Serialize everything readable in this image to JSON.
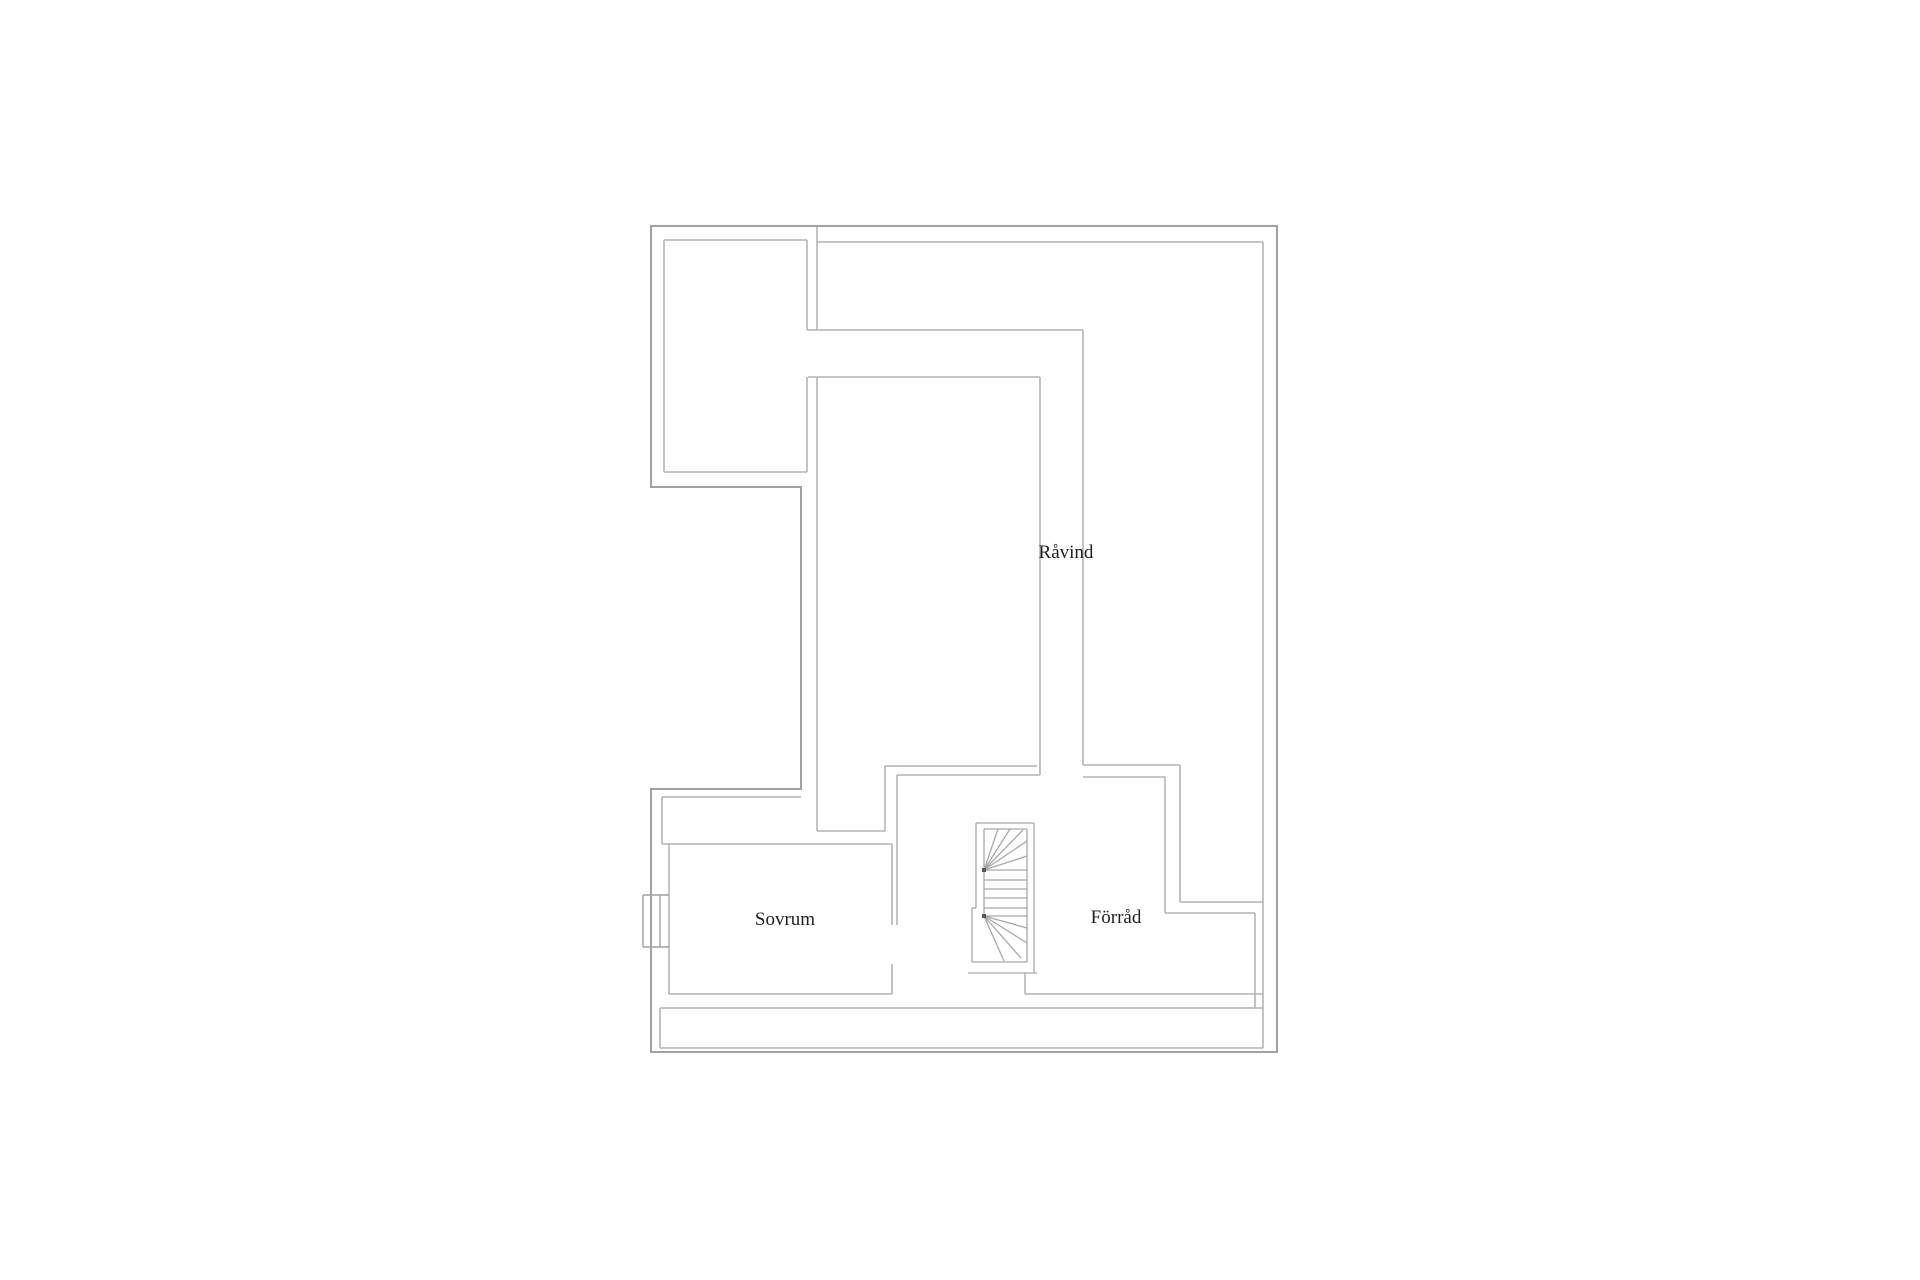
{
  "title": "Floor plan",
  "colors": {
    "background": "#ffffff",
    "outer_wall": "#a2a2a2",
    "inner_wall": "#b4b4b4",
    "stair_line": "#a8a8a8",
    "stair_hub": "#555555",
    "window_line": "#9f9f9f",
    "label_text": "#1f1f1f"
  },
  "rooms": [
    {
      "label": "Råvind"
    },
    {
      "label": "Sovrum"
    },
    {
      "label": "Förråd"
    }
  ],
  "plan": {
    "width": 1920,
    "height": 1280,
    "outer_polygon": [
      [
        651,
        226
      ],
      [
        1277,
        226
      ],
      [
        1277,
        1052
      ],
      [
        651,
        1052
      ],
      [
        651,
        789
      ],
      [
        801,
        789
      ],
      [
        801,
        487
      ],
      [
        651,
        487
      ]
    ],
    "wall_lines": [
      [
        664,
        240,
        807,
        240
      ],
      [
        664,
        240,
        664,
        472
      ],
      [
        664,
        472,
        807,
        472
      ],
      [
        807,
        240,
        807,
        330
      ],
      [
        807,
        377,
        807,
        472
      ],
      [
        817,
        226,
        817,
        330
      ],
      [
        817,
        377,
        817,
        831
      ],
      [
        817,
        242,
        1263,
        242
      ],
      [
        807,
        330,
        1083,
        330
      ],
      [
        808,
        377,
        1040,
        377
      ],
      [
        1040,
        377,
        1040,
        775
      ],
      [
        1083,
        330,
        1083,
        765
      ],
      [
        885,
        766,
        1037,
        766
      ],
      [
        897,
        775,
        1040,
        775
      ],
      [
        885,
        766,
        885,
        831
      ],
      [
        897,
        775,
        897,
        925
      ],
      [
        817,
        831,
        885,
        831
      ],
      [
        662,
        797,
        801,
        797
      ],
      [
        662,
        797,
        662,
        844
      ],
      [
        662,
        844,
        892,
        844
      ],
      [
        669,
        844,
        669,
        994
      ],
      [
        669,
        994,
        892,
        994
      ],
      [
        892,
        844,
        892,
        925
      ],
      [
        892,
        964,
        892,
        994
      ],
      [
        1083,
        765,
        1180,
        765
      ],
      [
        1180,
        765,
        1180,
        902
      ],
      [
        1180,
        902,
        1263,
        902
      ],
      [
        1083,
        777,
        1165,
        777
      ],
      [
        1165,
        777,
        1165,
        913
      ],
      [
        1165,
        913,
        1255,
        913
      ],
      [
        1255,
        913,
        1255,
        1008
      ],
      [
        1263,
        242,
        1263,
        1048
      ],
      [
        1025,
        994,
        1263,
        994
      ],
      [
        660,
        1008,
        1263,
        1008
      ],
      [
        660,
        1048,
        1263,
        1048
      ],
      [
        660,
        1008,
        660,
        1048
      ]
    ],
    "stair_lines": [
      [
        976,
        823,
        1034,
        823
      ],
      [
        976,
        823,
        976,
        908
      ],
      [
        972,
        908,
        976,
        908
      ],
      [
        972,
        908,
        972,
        962
      ],
      [
        1034,
        823,
        1034,
        973
      ],
      [
        968,
        973,
        1037,
        973
      ],
      [
        1025,
        973,
        1025,
        994
      ],
      [
        972,
        962,
        1027,
        962
      ],
      [
        984,
        829,
        1027,
        829
      ],
      [
        984,
        829,
        984,
        916
      ],
      [
        1027,
        829,
        1027,
        962
      ],
      [
        984,
        870,
        1027,
        870
      ],
      [
        984,
        880,
        1027,
        880
      ],
      [
        984,
        889,
        1027,
        889
      ],
      [
        984,
        898,
        1027,
        898
      ],
      [
        984,
        908,
        1027,
        908
      ],
      [
        984,
        916,
        1027,
        916
      ],
      [
        984,
        870,
        998,
        829
      ],
      [
        984,
        870,
        1010,
        829
      ],
      [
        984,
        870,
        1023,
        830
      ],
      [
        984,
        870,
        1027,
        841
      ],
      [
        984,
        870,
        1027,
        856
      ],
      [
        984,
        916,
        1027,
        928
      ],
      [
        984,
        916,
        1027,
        943
      ],
      [
        984,
        916,
        1021,
        958
      ],
      [
        984,
        916,
        1004,
        961
      ]
    ],
    "stair_hubs": [
      [
        984,
        870
      ],
      [
        984,
        916
      ]
    ],
    "window_lines": [
      [
        643,
        895,
        669,
        895
      ],
      [
        643,
        947,
        669,
        947
      ],
      [
        643,
        895,
        643,
        947
      ],
      [
        660,
        895,
        660,
        947
      ]
    ],
    "labels": [
      {
        "name": "room-label-ravind",
        "text": "Råvind",
        "x": 1066,
        "y": 558,
        "size": 19
      },
      {
        "name": "room-label-sovrum",
        "text": "Sovrum",
        "x": 785,
        "y": 925,
        "size": 19
      },
      {
        "name": "room-label-forrad",
        "text": "Förråd",
        "x": 1116,
        "y": 923,
        "size": 19
      }
    ]
  }
}
